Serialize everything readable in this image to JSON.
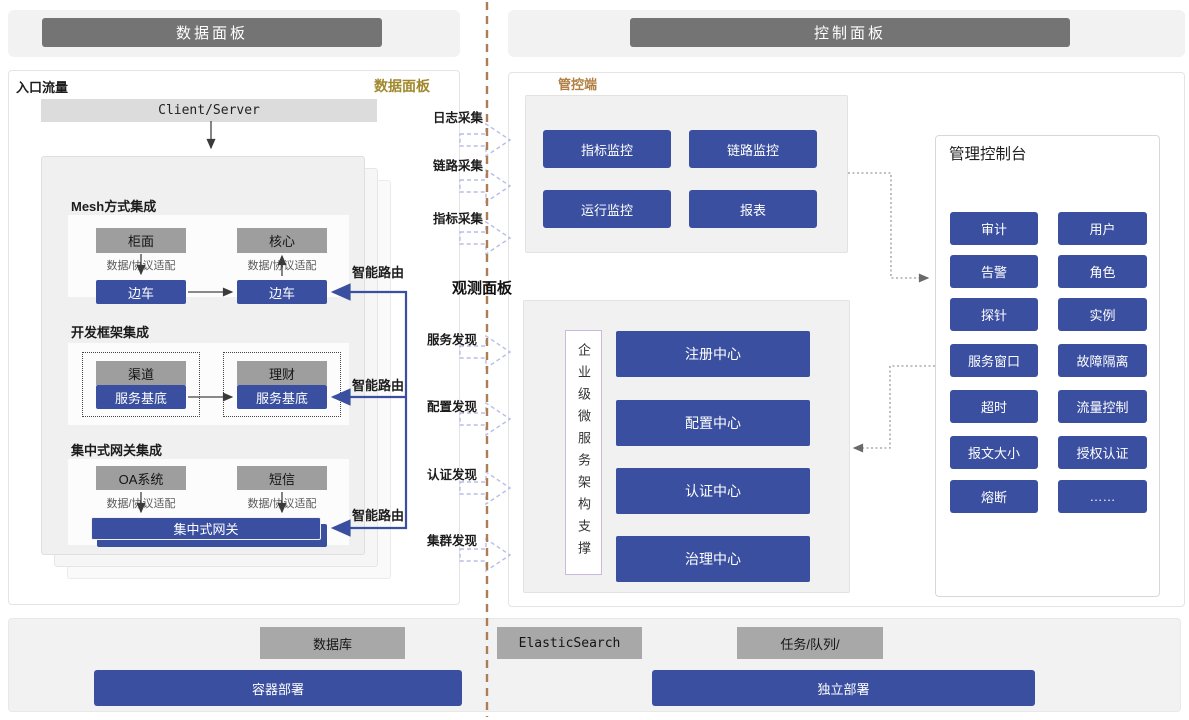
{
  "headers": {
    "left": "数据面板",
    "right": "控制面板"
  },
  "data_panel": {
    "corner_label": "入口流量",
    "panel_label": "数据面板",
    "client_server": "Client/Server",
    "adapter_label": "数据/协议适配",
    "smart_route_label": "智能路由",
    "sections": {
      "mesh": {
        "title": "Mesh方式集成",
        "left_top": "柜面",
        "right_top": "核心",
        "left_bottom": "边车",
        "right_bottom": "边车"
      },
      "framework": {
        "title": "开发框架集成",
        "left_top": "渠道",
        "left_bottom": "服务基底",
        "right_top": "理财",
        "right_bottom": "服务基底"
      },
      "gateway": {
        "title": "集中式网关集成",
        "left_top": "OA系统",
        "right_top": "短信",
        "bar": "集中式网关"
      }
    }
  },
  "middle": {
    "collect_labels": [
      "日志采集",
      "链路采集",
      "指标采集"
    ],
    "observe_title": "观测面板",
    "discover_labels": [
      "服务发现",
      "配置发现",
      "认证发现",
      "集群发现"
    ]
  },
  "control_panel": {
    "label": "管控端",
    "monitor_buttons": [
      "指标监控",
      "链路监控",
      "运行监控",
      "报表"
    ],
    "observe": {
      "vertical_label": "企业级微服务架构支撑",
      "centers": [
        "注册中心",
        "配置中心",
        "认证中心",
        "治理中心"
      ]
    },
    "console": {
      "title": "管理控制台",
      "buttons": [
        "审计",
        "用户",
        "告警",
        "角色",
        "探针",
        "实例",
        "服务窗口",
        "故障隔离",
        "超时",
        "流量控制",
        "报文大小",
        "授权认证",
        "熔断",
        "……"
      ]
    }
  },
  "bottom": {
    "labels": [
      "数据库",
      "ElasticSearch",
      "任务/队列/"
    ],
    "deploy": [
      "容器部署",
      "独立部署"
    ]
  },
  "colors": {
    "blue": "#3a4fa0",
    "box_gray": "#9e9e9e",
    "header_gray": "#747474",
    "panel_gray": "#f2f2f2",
    "divider_brown": "#ad7d55",
    "gold": "#a0892c",
    "orange": "#b17f41",
    "dashed_arrow": "#b6bde6"
  }
}
